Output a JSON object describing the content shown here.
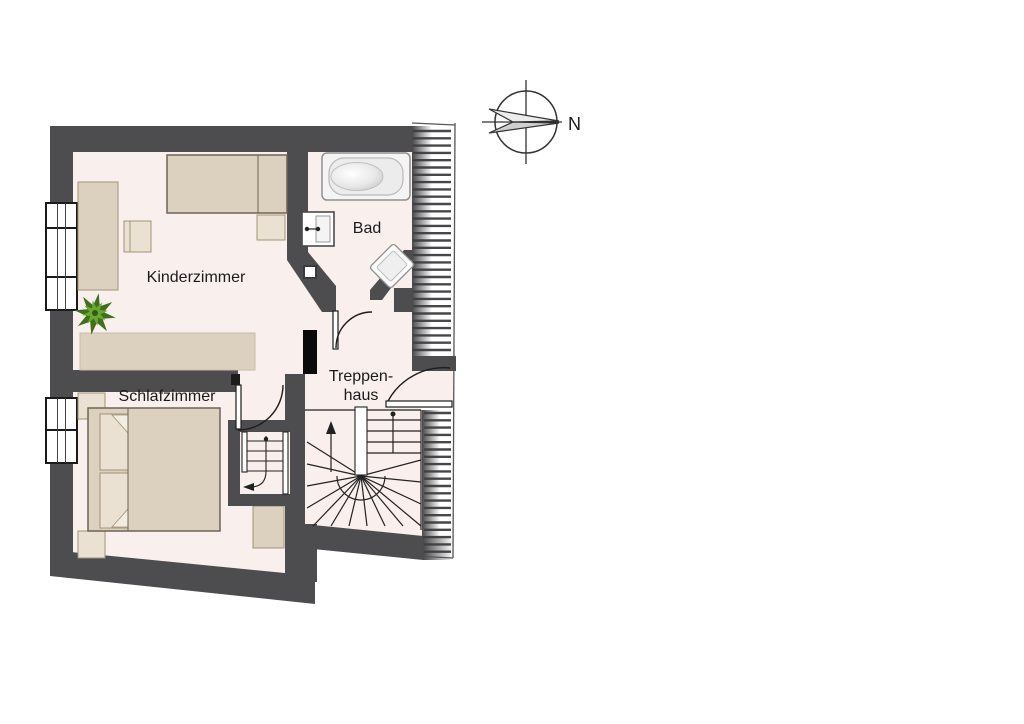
{
  "plan": {
    "type": "floor-plan",
    "floor_label_rooms": [
      "Kinderzimmer",
      "Schlafzimmer",
      "Bad",
      "Treppenhaus"
    ]
  },
  "rooms": {
    "kinderzimmer": {
      "label": "Kinderzimmer"
    },
    "schlafzimmer": {
      "label": "Schlafzimmer"
    },
    "bad": {
      "label": "Bad"
    },
    "treppenhaus": {
      "line1": "Treppen-",
      "line2": "haus"
    }
  },
  "compass": {
    "label": "N"
  },
  "colors": {
    "wall": "#4d4d4f",
    "wall_black": "#0a0a0a",
    "floor": "#f9efec",
    "furniture": "#dcd0bf",
    "furniture_light": "#eae1d2",
    "furniture_stroke": "#a29378",
    "sideboard_stroke": "#c7bba8",
    "fixture_fill": "#f4f4f4",
    "fixture_stroke": "#909090",
    "line": "#222222",
    "hatch": "#47474a",
    "window_frame": "#1a1a1a",
    "plant_dark": "#3f7020",
    "plant_light": "#6aa832",
    "plant_core": "#2f5a18",
    "white": "#ffffff"
  }
}
